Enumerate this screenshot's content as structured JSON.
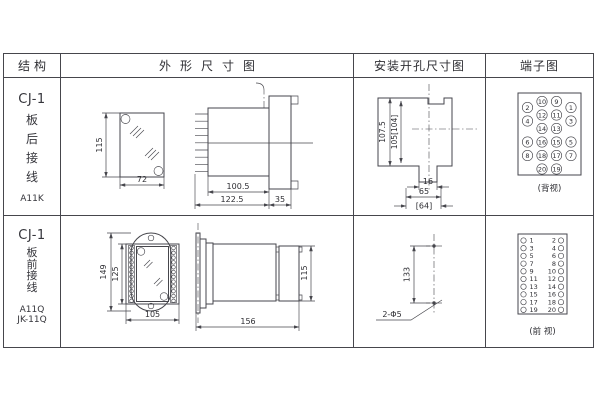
{
  "header": {
    "structure": "结构",
    "outline": "外形尺寸图",
    "mounting": "安装开孔尺寸图",
    "terminal": "端子图"
  },
  "colors": {
    "line": "#46464c",
    "text": "#2e2e33",
    "background": "#ffffff"
  },
  "row1": {
    "structure": {
      "model": "CJ-1",
      "wiring": [
        "板",
        "后",
        "接",
        "线"
      ],
      "code": "A11K"
    },
    "outline_dims": {
      "height": "115",
      "width": "72",
      "body_depth": "100.5",
      "total_depth": "122.5",
      "flange_depth": "35"
    },
    "mounting_dims": {
      "outer_height": "107.5",
      "inner_height": "105[104]",
      "slot_width": "16",
      "width": "65",
      "width_alt": "[64]"
    },
    "terminal": {
      "view": "(背视)",
      "mid": [
        "10",
        "9",
        "12",
        "11",
        "14",
        "13",
        "16",
        "15",
        "18",
        "17",
        "20",
        "19"
      ],
      "left": [
        "2",
        "4",
        "6",
        "8"
      ],
      "right": [
        "1",
        "3",
        "5",
        "7"
      ]
    }
  },
  "row2": {
    "structure": {
      "model": "CJ-1",
      "wiring": [
        "板",
        "前",
        "接",
        "线"
      ],
      "codes": [
        "A11Q",
        "JK-11Q"
      ]
    },
    "outline_dims": {
      "outer_height": "149",
      "inner_height": "125",
      "width": "105",
      "total_depth": "156",
      "side_height": "115"
    },
    "mounting_dims": {
      "hole_spacing": "133",
      "holes": "2-Φ5"
    },
    "terminal": {
      "view": "(前 视)",
      "rows": [
        [
          "1",
          "2"
        ],
        [
          "3",
          "4"
        ],
        [
          "5",
          "6"
        ],
        [
          "7",
          "8"
        ],
        [
          "9",
          "10"
        ],
        [
          "11",
          "12"
        ],
        [
          "13",
          "14"
        ],
        [
          "15",
          "16"
        ],
        [
          "17",
          "18"
        ],
        [
          "19",
          "20"
        ]
      ]
    }
  }
}
